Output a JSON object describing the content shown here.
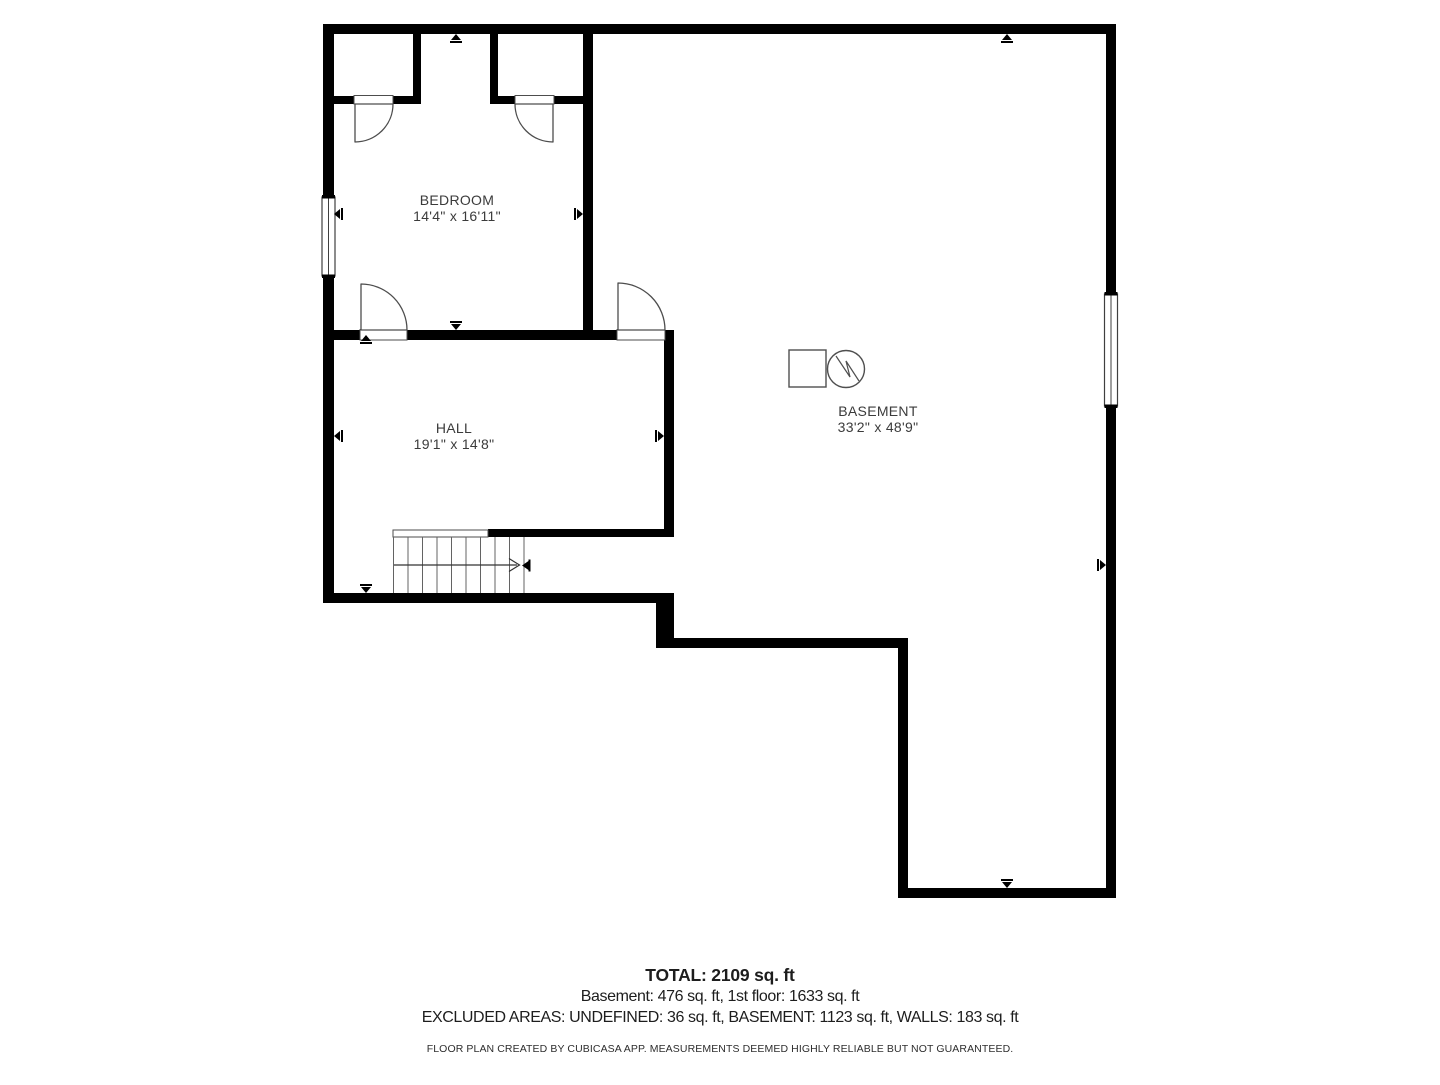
{
  "rooms": [
    {
      "name": "BEDROOM",
      "dims": "14'4\" x 16'11\""
    },
    {
      "name": "HALL",
      "dims": "19'1\" x 14'8\""
    },
    {
      "name": "BASEMENT",
      "dims": "33'2\" x 48'9\""
    }
  ],
  "summary": {
    "total": "TOTAL: 2109 sq. ft",
    "floors": "Basement: 476 sq. ft, 1st floor: 1633 sq. ft",
    "excluded": "EXCLUDED AREAS: UNDEFINED: 36 sq. ft, BASEMENT: 1123 sq. ft, WALLS: 183 sq. ft"
  },
  "disclaimer": "FLOOR PLAN CREATED BY CUBICASA APP. MEASUREMENTS DEEMED HIGHLY RELIABLE BUT NOT GUARANTEED.",
  "icons": {
    "appliance_square": "square-outline",
    "water_heater": "circle-zigzag"
  },
  "colors": {
    "wall": "#000000",
    "line": "#4d4d4d",
    "tread": "#636363",
    "label_text": "#3b3b3b",
    "summary_text": "#1d1d1d",
    "background": "#ffffff"
  }
}
